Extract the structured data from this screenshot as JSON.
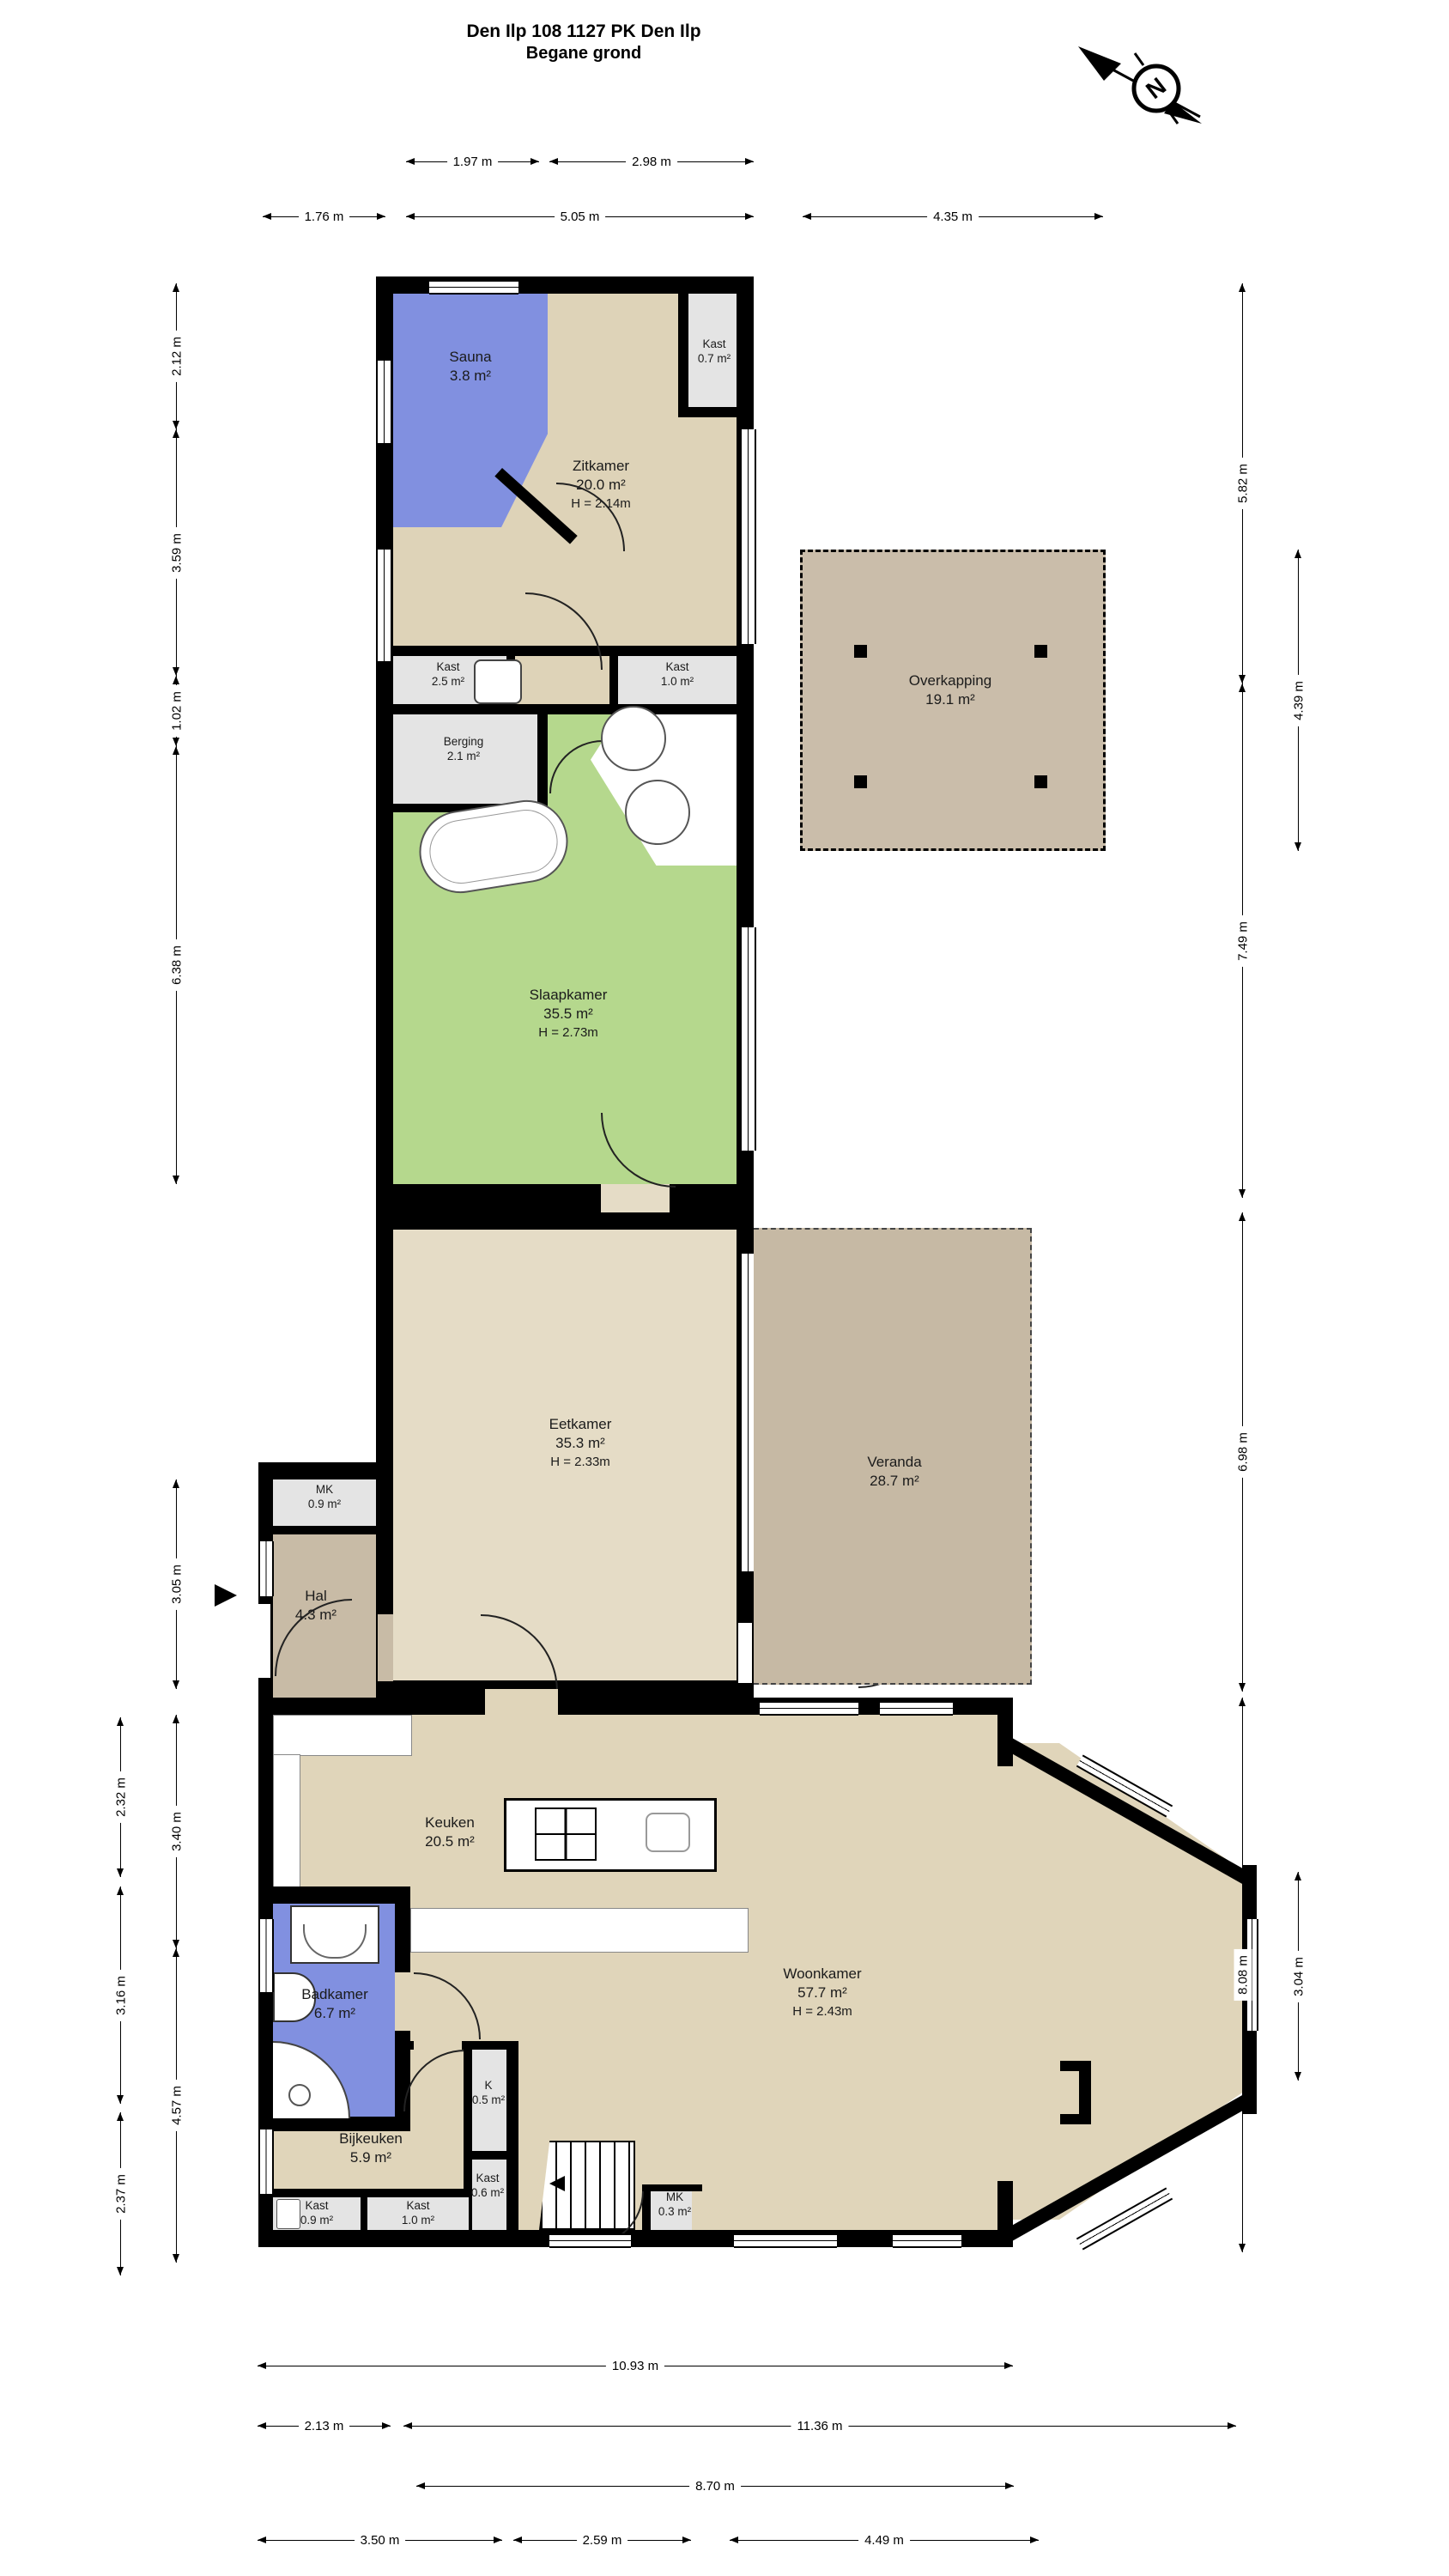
{
  "title": {
    "line1": "Den Ilp 108 1127 PK Den Ilp",
    "line2": "Begane grond"
  },
  "compass": {
    "letter": "N"
  },
  "rooms": {
    "sauna": {
      "name": "Sauna",
      "area": "3.8 m²"
    },
    "zitkamer": {
      "name": "Zitkamer",
      "area": "20.0 m²",
      "height": "H = 2.14m"
    },
    "kast07": {
      "name": "Kast",
      "area": "0.7 m²"
    },
    "kast25": {
      "name": "Kast",
      "area": "2.5 m²"
    },
    "kast10": {
      "name": "Kast",
      "area": "1.0 m²"
    },
    "berging": {
      "name": "Berging",
      "area": "2.1 m²"
    },
    "overkapping": {
      "name": "Overkapping",
      "area": "19.1 m²"
    },
    "slaapkamer": {
      "name": "Slaapkamer",
      "area": "35.5 m²",
      "height": "H = 2.73m"
    },
    "eetkamer": {
      "name": "Eetkamer",
      "area": "35.3 m²",
      "height": "H = 2.33m"
    },
    "veranda": {
      "name": "Veranda",
      "area": "28.7 m²"
    },
    "mk09": {
      "name": "MK",
      "area": "0.9 m²"
    },
    "hal": {
      "name": "Hal",
      "area": "4.3 m²"
    },
    "keuken": {
      "name": "Keuken",
      "area": "20.5 m²"
    },
    "badkamer": {
      "name": "Badkamer",
      "area": "6.7 m²"
    },
    "woonkamer": {
      "name": "Woonkamer",
      "area": "57.7 m²",
      "height": "H = 2.43m"
    },
    "k05": {
      "name": "K",
      "area": "0.5 m²"
    },
    "bijkeuken": {
      "name": "Bijkeuken",
      "area": "5.9 m²"
    },
    "kast06": {
      "name": "Kast",
      "area": "0.6 m²"
    },
    "kast09": {
      "name": "Kast",
      "area": "0.9 m²"
    },
    "kast10b": {
      "name": "Kast",
      "area": "1.0 m²"
    },
    "mk03": {
      "name": "MK",
      "area": "0.3 m²"
    }
  },
  "dims": {
    "top_row1": [
      "1.97 m",
      "2.98 m"
    ],
    "top_row2": [
      "1.76 m",
      "5.05 m",
      "4.35 m"
    ],
    "left": [
      "2.12 m",
      "3.59 m",
      "1.02 m",
      "6.38 m",
      "3.05 m"
    ],
    "left_lower_outer": [
      "2.32 m",
      "3.16 m",
      "2.37 m"
    ],
    "left_lower_inner": [
      "3.40 m",
      "4.57 m"
    ],
    "right_outer": [
      "5.82 m",
      "7.49 m",
      "6.98 m",
      "8.08 m"
    ],
    "right_inner": [
      "4.39 m",
      "3.04 m"
    ],
    "bottom": [
      "10.93 m",
      "2.13 m",
      "11.36 m",
      "8.70 m",
      "3.50 m",
      "2.59 m",
      "4.49 m"
    ]
  },
  "colors": {
    "wall": "#000000",
    "floor_beige": "#ded3b8",
    "floor_beige_light": "#e5dcc6",
    "floor_green": "#b5d88d",
    "floor_blue": "#8190e0",
    "floor_gray": "#e4e4e4",
    "floor_tan": "#c8bba6"
  }
}
